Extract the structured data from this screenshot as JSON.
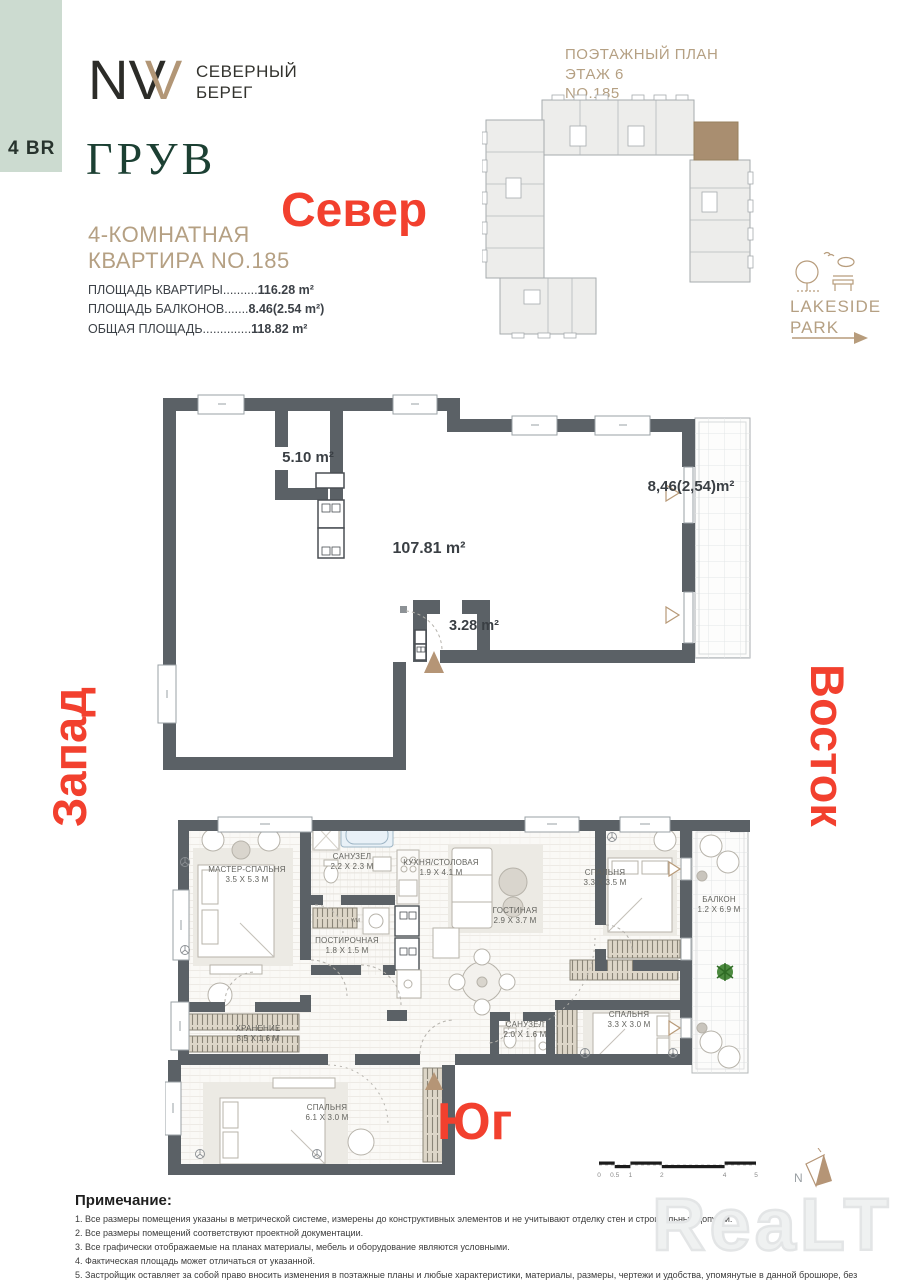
{
  "badge": {
    "label": "4 BR"
  },
  "brand": {
    "logo_letters": {
      "n": "N",
      "v1": "V",
      "v2": "V"
    },
    "name_line1": "СЕВЕРНЫЙ",
    "name_line2": "БЕРЕГ",
    "project_name": "ГРУВ"
  },
  "apartment": {
    "title_line1": "4-КОМНАТНАЯ",
    "title_line2": "КВАРТИРА NO.185",
    "specs": [
      {
        "label": "ПЛОЩАДЬ КВАРТИРЫ",
        "dots": "..........",
        "value": "116.28 m²"
      },
      {
        "label": "ПЛОЩАДЬ БАЛКОНОВ",
        "dots": ".......",
        "value": "8.46(2.54 m²)"
      },
      {
        "label": "ОБЩАЯ ПЛОЩАДЬ",
        "dots": "..............",
        "value": "118.82 m²"
      }
    ]
  },
  "floor_key": {
    "line1": "ПОЭТАЖНЫЙ ПЛАН",
    "line2": "ЭТАЖ 6",
    "line3": "NO.185"
  },
  "lakeside_park": {
    "line1": "LAKESIDE",
    "line2": "PARK"
  },
  "directions": {
    "north": "Север",
    "west": "Запад",
    "east": "Восток",
    "south": "Юг"
  },
  "schematic_plan": {
    "room_area": "5.10 m²",
    "main_area": "107.81 m²",
    "bath_area": "3.28 m²",
    "balcony_area": "8,46(2,54)m²"
  },
  "detailed_plan": {
    "rooms": [
      {
        "name": "МАСТЕР-СПАЛЬНЯ",
        "dim": "3.5 x 5.3 m"
      },
      {
        "name": "САНУЗЕЛ",
        "dim": "2.2 x 2.3 m"
      },
      {
        "name": "КУХНЯ/СТОЛОВАЯ",
        "dim": "1.9 x 4.1 m"
      },
      {
        "name": "ГОСТИНАЯ",
        "dim": "2.9 x 3.7 m"
      },
      {
        "name": "СПАЛЬНЯ",
        "dim": "3.3 x 3.5 m"
      },
      {
        "name": "БАЛКОН",
        "dim": "1.2 x 6.9 m"
      },
      {
        "name": "ПОСТИРОЧНАЯ",
        "dim": "1.8 x 1.5 m"
      },
      {
        "name": "ХРАНЕНИЕ",
        "dim": "3.5 x 1.6 m"
      },
      {
        "name": "САНУЗЕЛ",
        "dim": "2.0 x 1.6 m"
      },
      {
        "name": "СПАЛЬНЯ",
        "dim": "3.3 x 3.0 m"
      },
      {
        "name": "СПАЛЬНЯ",
        "dim": "6.1 x 3.0 m"
      }
    ],
    "washer_label": "WM"
  },
  "notes": {
    "title": "Примечание:",
    "items": [
      "1. Все размеры помещения указаны в метрической системе, измерены до конструктивных элементов и не учитывают отделку стен и строительные допуски.",
      "2. Все размеры помещений соответствуют проектной документации.",
      "3. Все графически отображаемые на планах материалы, мебель и оборудование являются условными.",
      "4. Фактическая площадь может отличаться от указанной.",
      "5. Застройщик оставляет за собой право вносить изменения в поэтажные планы и любые характеристики, материалы, размеры, чертежи и удобства, упомянутые в данной брошюре, без предварительного уведомления."
    ]
  },
  "scale_bar": {
    "ticks": [
      "0",
      "0.5",
      "1",
      "2",
      "4",
      "5"
    ]
  },
  "compass": {
    "north_letter": "N"
  },
  "watermark": "ReaLT",
  "colors": {
    "accent_red": "#f2402e",
    "tan": "#b5a083",
    "wall_gray": "#5b6166",
    "brand_green": "#1c4033",
    "sage": "#ccdbd0",
    "unit_brown": "#a98e70"
  }
}
